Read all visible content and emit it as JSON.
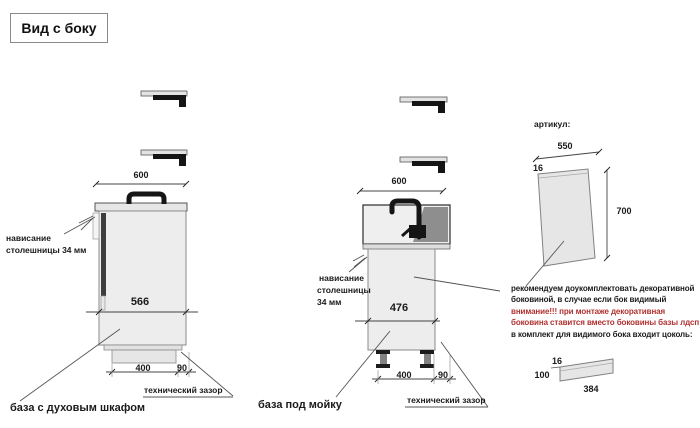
{
  "title": "Вид с боку",
  "colors": {
    "note_warning_red": "#b03030",
    "drawing_dark": "#3d3d3d"
  },
  "oven_base": {
    "label": "база с духовым шкафом",
    "width_dim": "600",
    "depth_dim": "566",
    "plinth_dim": "400",
    "gap_dim": "90",
    "gap_label": "технический зазор",
    "overhang_line1": "нависание",
    "overhang_line2": "столешницы 34 мм"
  },
  "sink_base": {
    "label": "база под мойку",
    "width_dim": "600",
    "depth_dim": "476",
    "plinth_dim": "400",
    "gap_dim": "90",
    "gap_label": "технический зазор",
    "overhang_line1": "нависание",
    "overhang_line2": "столешницы",
    "overhang_line3": "34 мм"
  },
  "side_panel": {
    "heading": "артикул:",
    "width_dim": "550",
    "thickness_dim": "16",
    "height_dim": "700"
  },
  "plinth_panel": {
    "thickness_dim": "16",
    "height_dim": "100",
    "length_dim": "384"
  },
  "note": {
    "line1": "рекомендуем доукомплектовать декоративной",
    "line2": "боковиной, в случае если бок видимый",
    "line3": "внимание!!! при монтаже декоративная",
    "line4": "боковина ставится вместо боковины базы лдсп",
    "line5": "в комплект для видимого бока входит цоколь:"
  }
}
